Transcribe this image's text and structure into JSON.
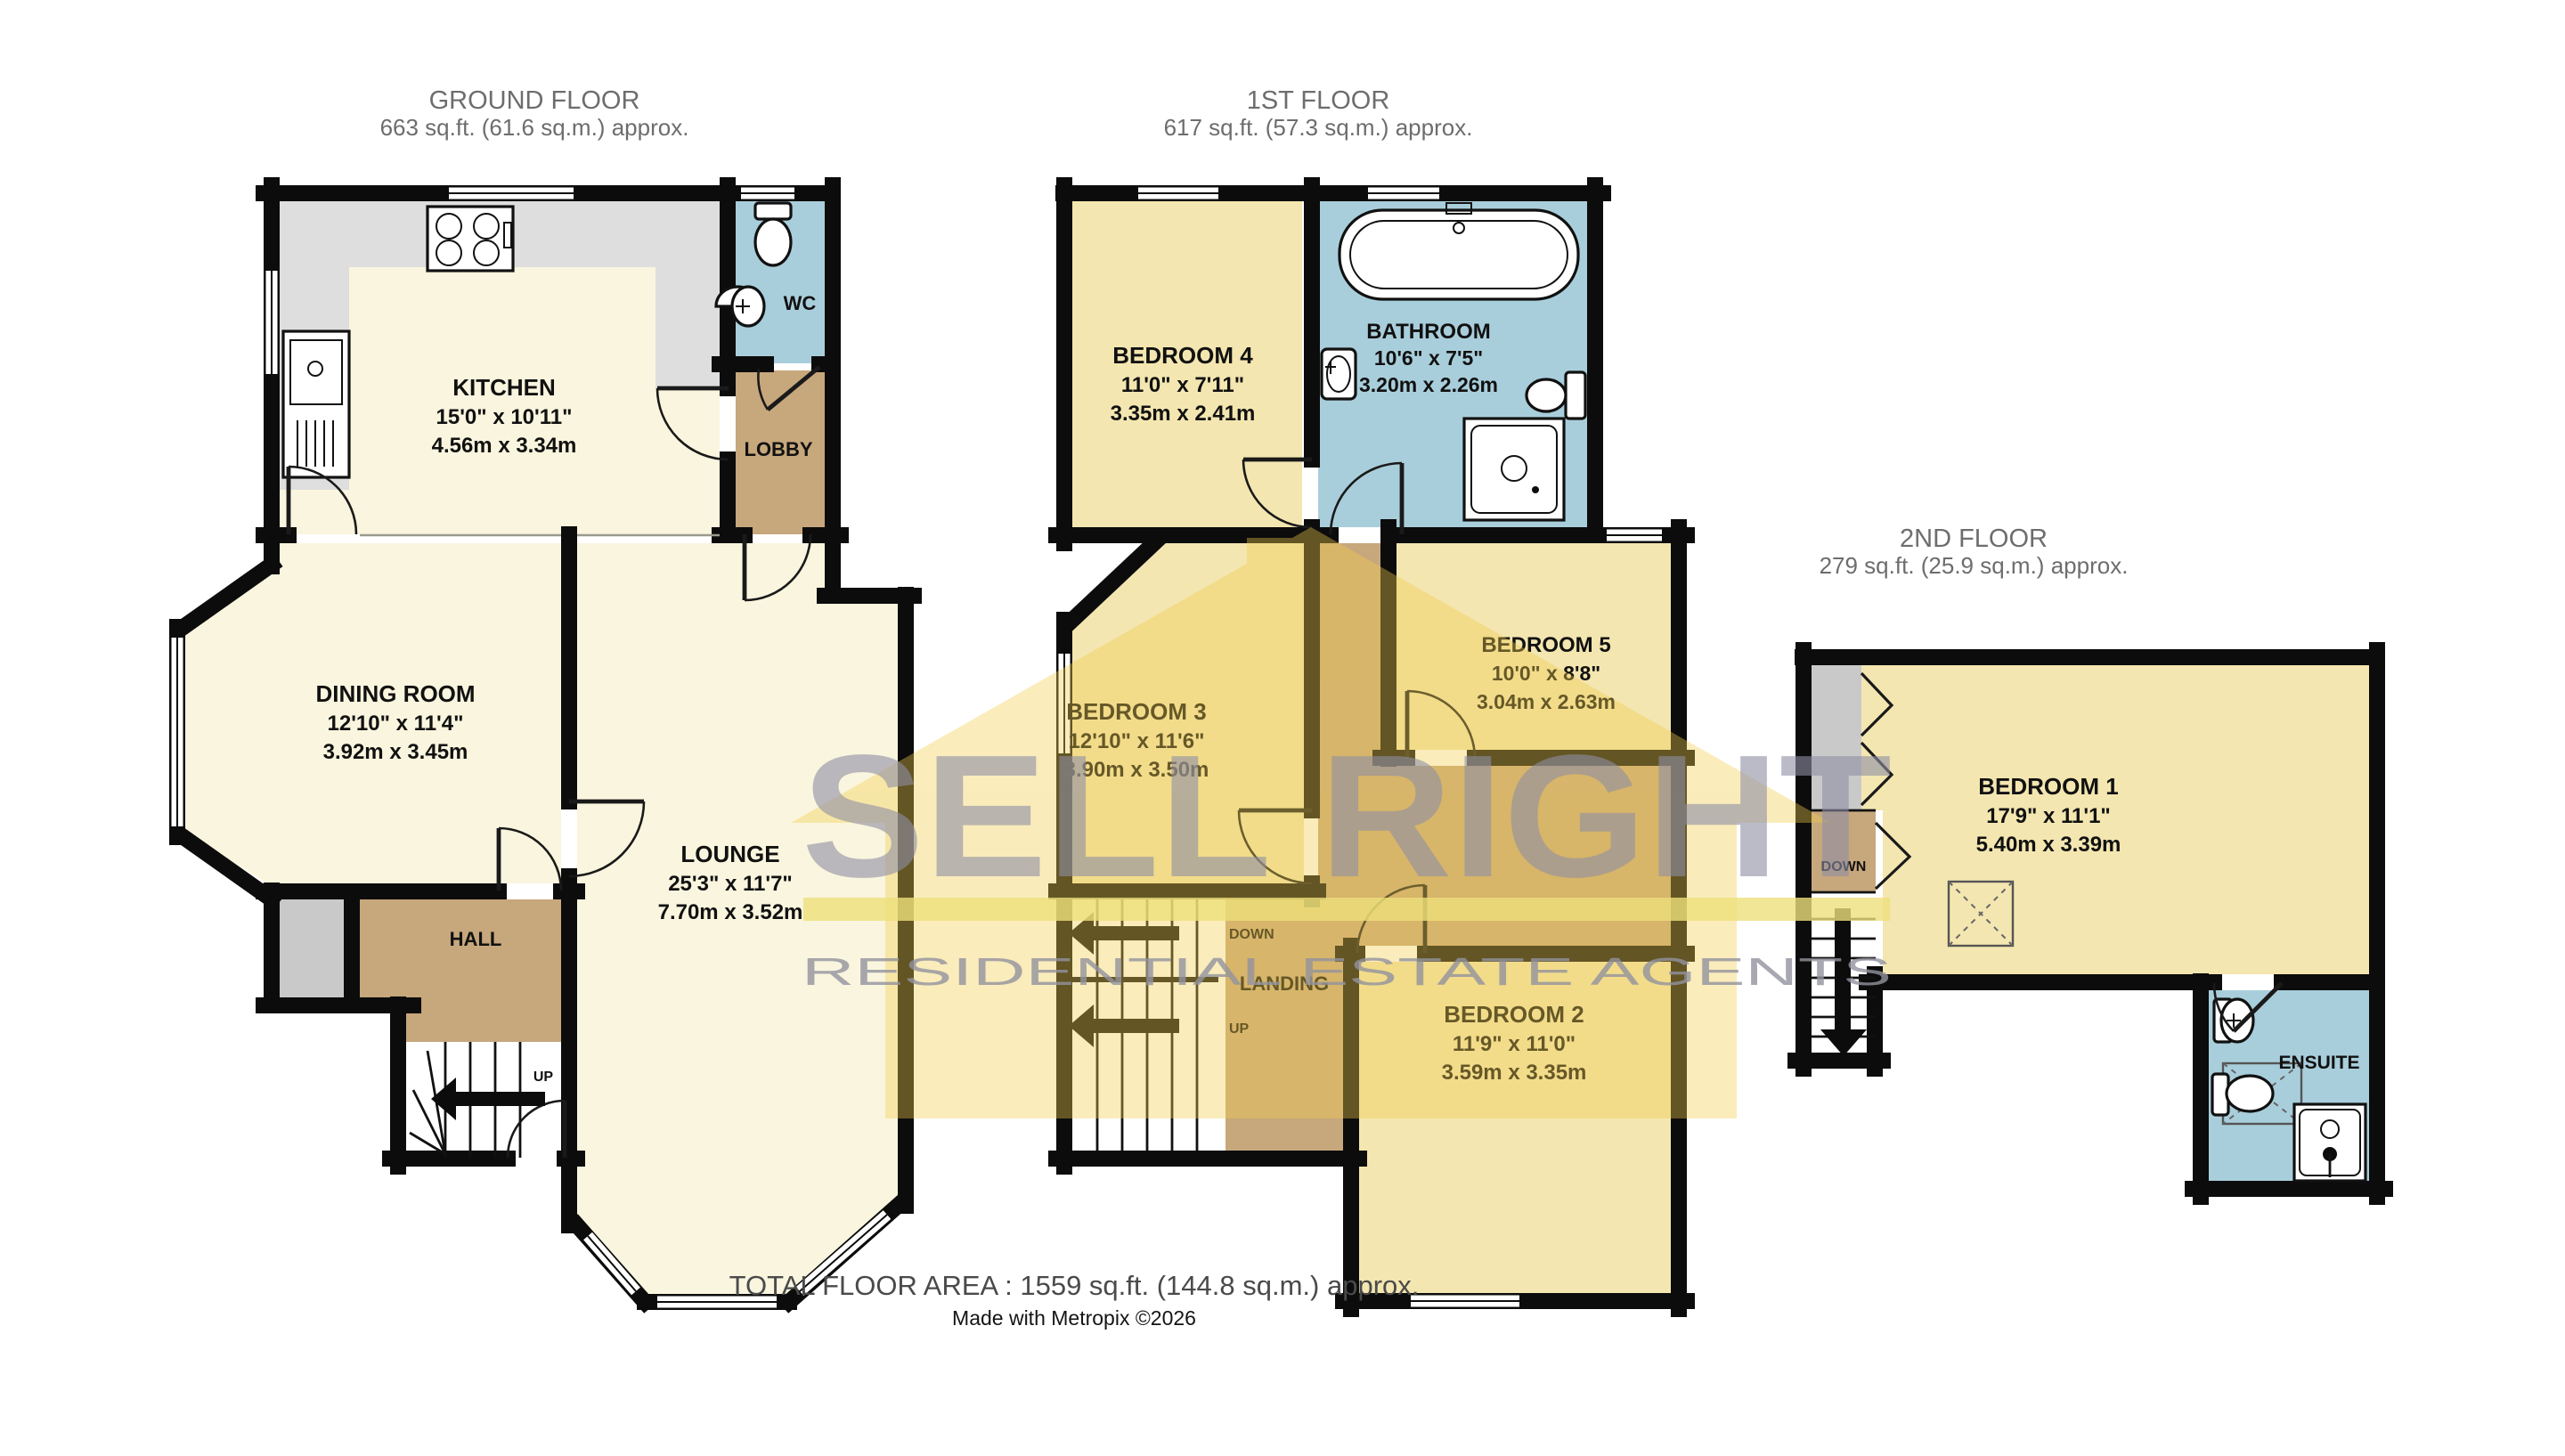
{
  "floors": {
    "ground": {
      "title": "GROUND FLOOR",
      "area": "663 sq.ft. (61.6 sq.m.) approx.",
      "kitchen": {
        "name": "KITCHEN",
        "imperial": "15'0\" x 10'11\"",
        "metric": "4.56m x 3.34m"
      },
      "wc": {
        "name": "WC"
      },
      "lobby": {
        "name": "LOBBY"
      },
      "dining": {
        "name": "DINING ROOM",
        "imperial": "12'10\" x 11'4\"",
        "metric": "3.92m x 3.45m"
      },
      "lounge": {
        "name": "LOUNGE",
        "imperial": "25'3\" x 11'7\"",
        "metric": "7.70m x 3.52m"
      },
      "hall": {
        "name": "HALL"
      },
      "stairs_up": "UP"
    },
    "first": {
      "title": "1ST FLOOR",
      "area": "617 sq.ft. (57.3 sq.m.) approx.",
      "bedroom4": {
        "name": "BEDROOM 4",
        "imperial": "11'0\" x 7'11\"",
        "metric": "3.35m x 2.41m"
      },
      "bathroom": {
        "name": "BATHROOM",
        "imperial": "10'6\" x 7'5\"",
        "metric": "3.20m x 2.26m"
      },
      "bedroom3": {
        "name": "BEDROOM 3",
        "imperial": "12'10\" x 11'6\"",
        "metric": "3.90m x 3.50m"
      },
      "bedroom5": {
        "name": "BEDROOM 5",
        "imperial": "10'0\" x 8'8\"",
        "metric": "3.04m x 2.63m"
      },
      "bedroom2": {
        "name": "BEDROOM 2",
        "imperial": "11'9\" x 11'0\"",
        "metric": "3.59m x 3.35m"
      },
      "landing": {
        "name": "LANDING"
      },
      "stairs_down": "DOWN",
      "stairs_up": "UP"
    },
    "second": {
      "title": "2ND FLOOR",
      "area": "279 sq.ft. (25.9 sq.m.) approx.",
      "bedroom1": {
        "name": "BEDROOM 1",
        "imperial": "17'9\" x 11'1\"",
        "metric": "5.40m x 3.39m"
      },
      "ensuite": {
        "name": "ENSUITE"
      },
      "stairs_down": "DOWN"
    }
  },
  "footer": {
    "total": "TOTAL FLOOR AREA : 1559 sq.ft. (144.8 sq.m.) approx.",
    "credit": "Made with Metropix ©2026"
  },
  "watermark": {
    "brand": "SELL RIGHT",
    "tagline": "RESIDENTIAL ESTATE AGENTS"
  },
  "colors": {
    "living_cream": "#FAF5DE",
    "bedroom_yellow": "#F3E6B0",
    "bathroom_blue": "#A9CEDB",
    "circulation_tan": "#C7A77C",
    "storage_gray": "#C9C9C9",
    "counter_gray": "#DEDEDE",
    "wall_black": "#0C0C0C",
    "watermark_gray": "#8F8FA5",
    "watermark_yellow": "#F2CE4C"
  }
}
